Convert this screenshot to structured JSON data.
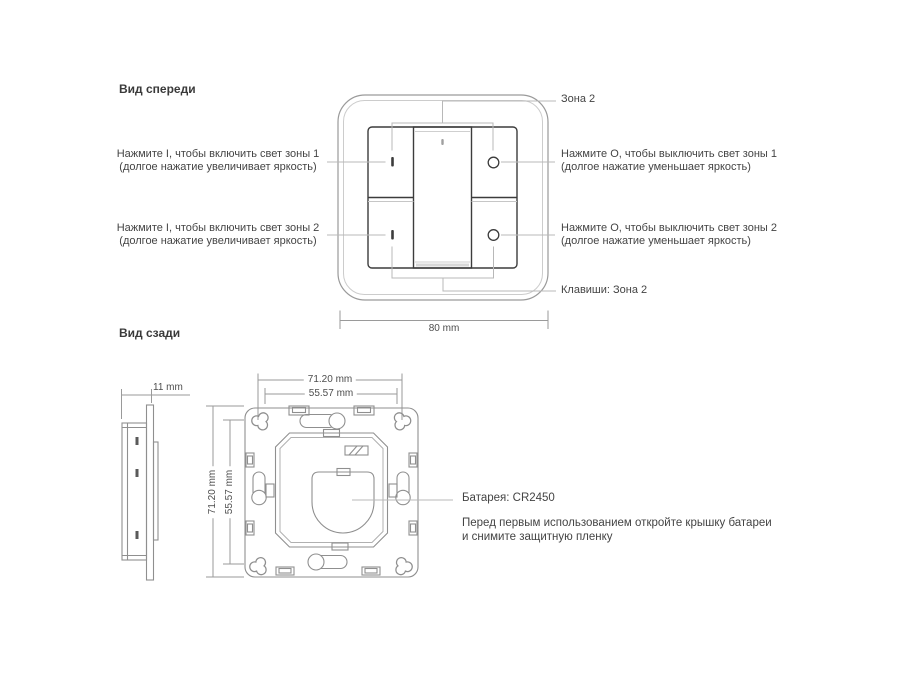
{
  "front_view": {
    "title": "Вид спереди",
    "callouts": {
      "zone2": "Зона 2",
      "keys_zone2": "Клавиши: Зона 2",
      "on_zone1": {
        "line1": "Нажмите I, чтобы включить свет зоны 1",
        "line2": "(долгое нажатие увеличивает яркость)"
      },
      "off_zone1": {
        "line1": "Нажмите O, чтобы выключить свет зоны 1",
        "line2": "(долгое нажатие уменьшает яркость)"
      },
      "on_zone2": {
        "line1": "Нажмите I, чтобы включить свет зоны 2",
        "line2": "(долгое нажатие увеличивает яркость)"
      },
      "off_zone2": {
        "line1": "Нажмите O, чтобы выключить свет зоны 2",
        "line2": "(долгое нажатие уменьшает яркость)"
      }
    },
    "button_marks": {
      "on": "I",
      "off": "O"
    },
    "dimensions": {
      "width": "80 mm"
    }
  },
  "back_view": {
    "title": "Вид сзади",
    "dimensions": {
      "depth": "11 mm",
      "mount_width": "71.20 mm",
      "inner_width": "55.57 mm",
      "mount_height": "71.20 mm",
      "inner_height": "55.57 mm"
    },
    "battery": {
      "label": "Батарея: CR2450",
      "note": {
        "line1": "Перед первым использованием откройте крышку батареи",
        "line2": "и снимите защитную пленку"
      }
    }
  },
  "colors": {
    "background": "#ffffff",
    "device_outline": "#9a9a9a",
    "dark_outline": "#3c3c3c",
    "leader_line": "#b8b8b8",
    "text": "#434343"
  }
}
